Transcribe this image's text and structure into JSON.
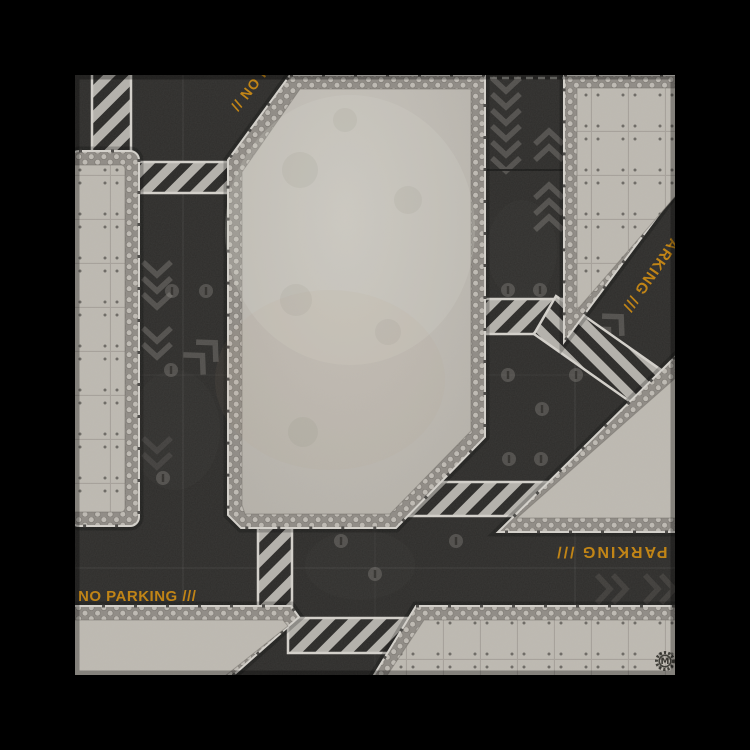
{
  "mat": {
    "markings": {
      "top_left_diagonal": "// NO PARKING",
      "top_right_diagonal": "NO PARKING ///",
      "bottom_right_inverted": "NO PARKING ///",
      "bottom_left_horizontal": "NO PARKING ///"
    },
    "logo": {
      "letter": "M"
    }
  },
  "colors": {
    "background": "#000000",
    "asphalt": "#2e2d2b",
    "asphaltLight": "#57544f",
    "concrete": "#bdb9b1",
    "concreteLight": "#ccc8c1",
    "hexBg": "#8f8b85",
    "hexCell": "#bebab3",
    "edgeLight": "#d4d1cb",
    "stripeLight": "#b4b1ab",
    "stripeDark": "#2b2a28",
    "marking": "#c9870e",
    "chevron": "#a5a29b",
    "dot": "#8a8781",
    "grid": "#ffffff",
    "logoInk": "#1c1b16"
  }
}
